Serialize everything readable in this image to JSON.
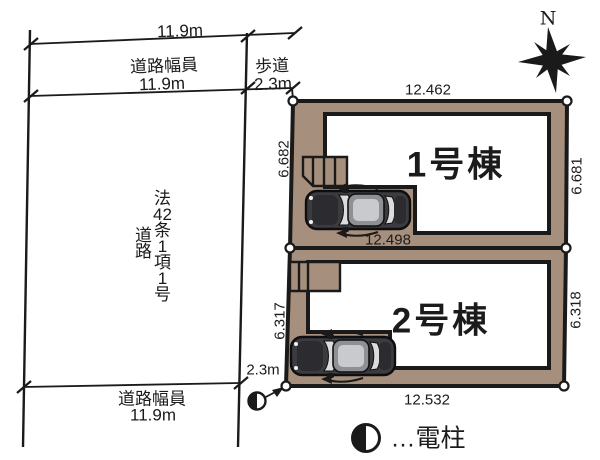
{
  "compass": {
    "north_label": "N"
  },
  "road": {
    "top_width": "11.9m",
    "width_label": "道路幅員",
    "width_value": "11.9m",
    "sidewalk_label": "歩道",
    "sidewalk_value": "2.3m",
    "legal_line1": [
      "法",
      "42",
      "条",
      "1",
      "項",
      "1",
      "号"
    ],
    "legal_line2": [
      "道",
      "路"
    ],
    "bottom_sidewalk_value": "2.3m",
    "bottom_width_label": "道路幅員",
    "bottom_width_value": "11.9m"
  },
  "lots": [
    {
      "name": "1号棟",
      "top": "12.462",
      "left": "6.682",
      "right": "6.681",
      "bottom": "12.498"
    },
    {
      "name": "2号棟",
      "left": "6.317",
      "right": "6.318",
      "bottom": "12.532"
    }
  ],
  "legend": {
    "symbol": "utility-pole",
    "label": "…電柱"
  },
  "colors": {
    "lot_fill": "#a78f7d",
    "outline": "#1a1a1a",
    "car_body": "#3b3b40",
    "car_roof": "#8f9094"
  }
}
